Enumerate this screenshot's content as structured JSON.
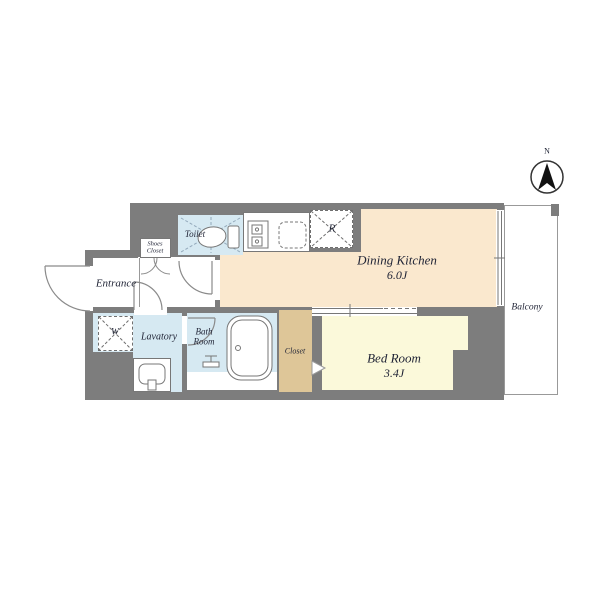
{
  "floor_plan": {
    "compass": {
      "north": "N"
    },
    "rooms": {
      "entrance": {
        "label": "Entrance"
      },
      "shoes_closet": {
        "line1": "Shoes",
        "line2": "Closet"
      },
      "toilet": {
        "label": "Toilet"
      },
      "lavatory": {
        "label": "Lavatory"
      },
      "bath_room": {
        "line1": "Bath",
        "line2": "Room"
      },
      "closet": {
        "label": "Closet"
      },
      "dining_kitchen": {
        "label": "Dining Kitchen",
        "area": "6.0J"
      },
      "bed_room": {
        "label": "Bed Room",
        "area": "3.4J"
      },
      "balcony": {
        "label": "Balcony"
      }
    },
    "fixtures": {
      "washing_machine_mark": "W",
      "refrigerator_mark": "R"
    },
    "colors": {
      "wall": "#7d7d7d",
      "water": "#d6e9f2",
      "dk": "#fae8ce",
      "bed": "#fbf9da",
      "closet": "#dec698",
      "line": "#777777",
      "text": "#1f2335"
    }
  }
}
